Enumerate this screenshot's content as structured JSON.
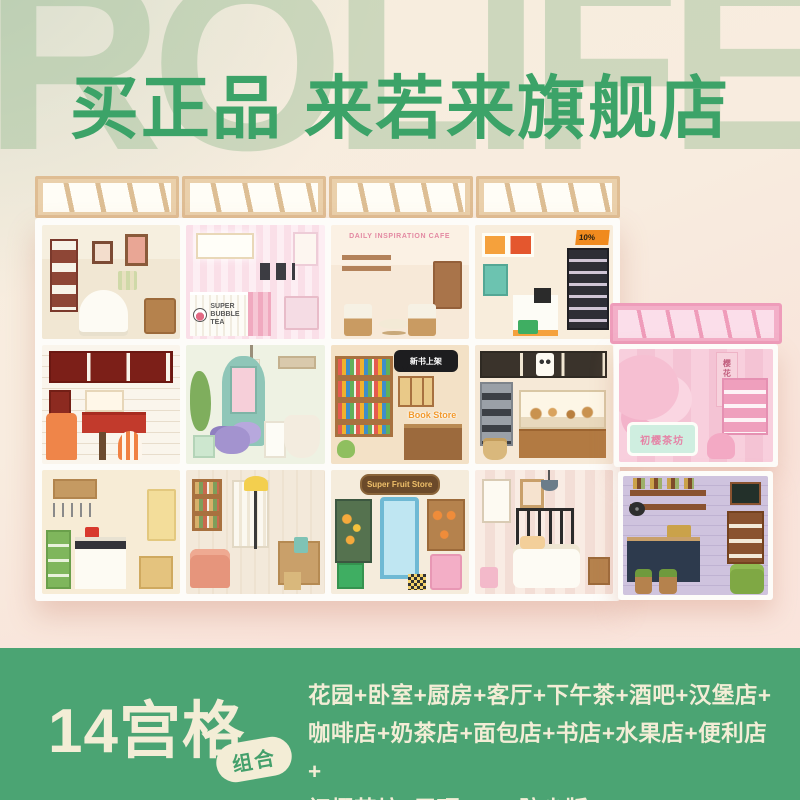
{
  "colors": {
    "headline_green": "#3ca368",
    "band_green": "#4ba473",
    "cream_text": "#f3edd6",
    "background_sage": "#d7ddcc",
    "background_pink": "#f9e3da",
    "teahouse_pink": "#f3afc8"
  },
  "header": {
    "watermark": "ROLIFE",
    "headline": "买正品 来若来旗舰店"
  },
  "photo": {
    "rooms": [
      {
        "key": "afternoon-tea",
        "name_cn": "下午茶"
      },
      {
        "key": "bubble-tea",
        "name_cn": "奶茶店",
        "sign": "SUPER BUBBLE TEA"
      },
      {
        "key": "cafe",
        "name_cn": "咖啡店",
        "sign": "DAILY INSPIRATION CAFE"
      },
      {
        "key": "convenience",
        "name_cn": "便利店",
        "sale": "10%"
      },
      {
        "key": "burger",
        "name_cn": "汉堡店"
      },
      {
        "key": "garden",
        "name_cn": "花园"
      },
      {
        "key": "bookstore",
        "name_cn": "书店",
        "bubble": "新书上架",
        "sign": "Book Store"
      },
      {
        "key": "bakery",
        "name_cn": "面包店"
      },
      {
        "key": "teahouse",
        "name_cn": "初樱茶坊",
        "sign": "初樱茶坊",
        "banner": "樱花吃茶"
      },
      {
        "key": "kitchen",
        "name_cn": "厨房"
      },
      {
        "key": "living-room",
        "name_cn": "客厅"
      },
      {
        "key": "fruit-store",
        "name_cn": "水果店",
        "sign": "Super Fruit Store"
      },
      {
        "key": "bedroom",
        "name_cn": "卧室"
      },
      {
        "key": "bar",
        "name_cn": "酒吧"
      }
    ]
  },
  "footer": {
    "title": "14宫格",
    "badge": "组合",
    "lines": [
      "花园+卧室+厨房+客厅+下午茶+酒吧+汉堡店+",
      "咖啡店+奶茶店+面包店+书店+水果店+便利店+",
      "初樱茶坊+屋顶B*4 +防尘版B*15"
    ]
  }
}
